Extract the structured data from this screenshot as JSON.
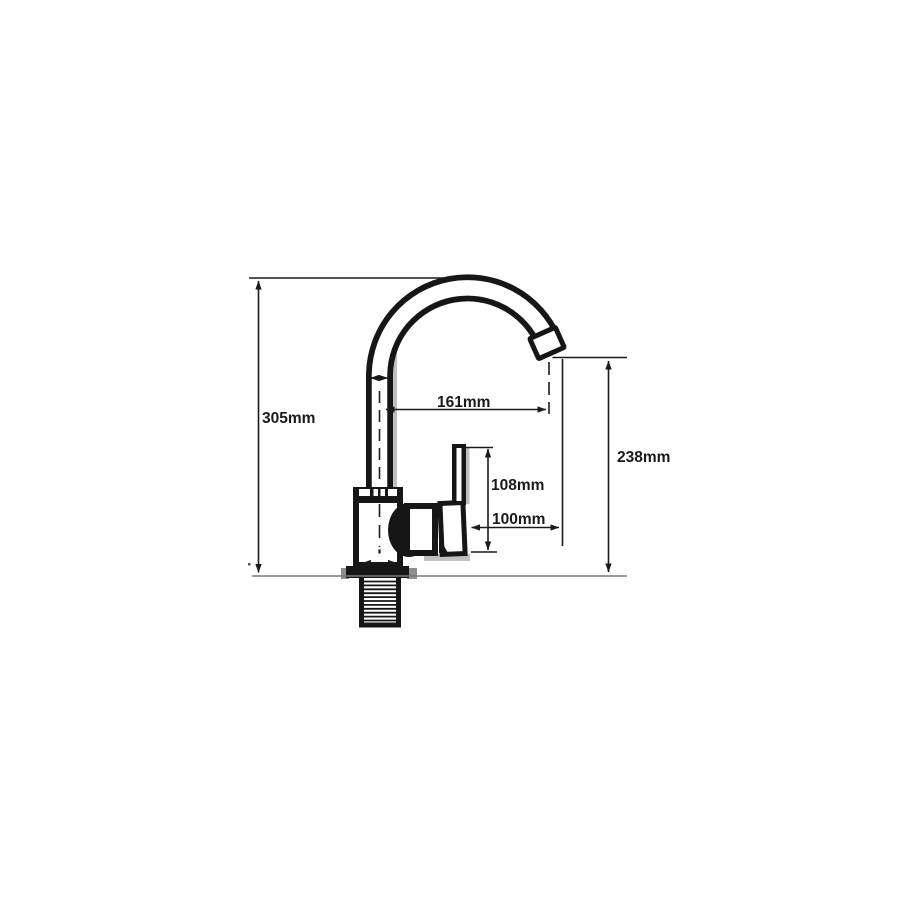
{
  "colors": {
    "ink": "#1a1a1a",
    "drawing": "#161616",
    "shadow": "#c0c0c0",
    "surface_line": "#7a7a7a",
    "background": "#ffffff"
  },
  "diagram": {
    "type": "technical-dimension-drawing",
    "subject": "kitchen faucet with gooseneck spout, side view",
    "unit": "mm",
    "dimensions": {
      "total_height": {
        "label": "305mm",
        "value_mm": 305
      },
      "spout_reach": {
        "label": "161mm",
        "value_mm": 161
      },
      "spout_outlet_height": {
        "label": "238mm",
        "value_mm": 238
      },
      "handle_height": {
        "label": "108mm",
        "value_mm": 108
      },
      "handle_reach": {
        "label": "100mm",
        "value_mm": 100
      }
    }
  }
}
